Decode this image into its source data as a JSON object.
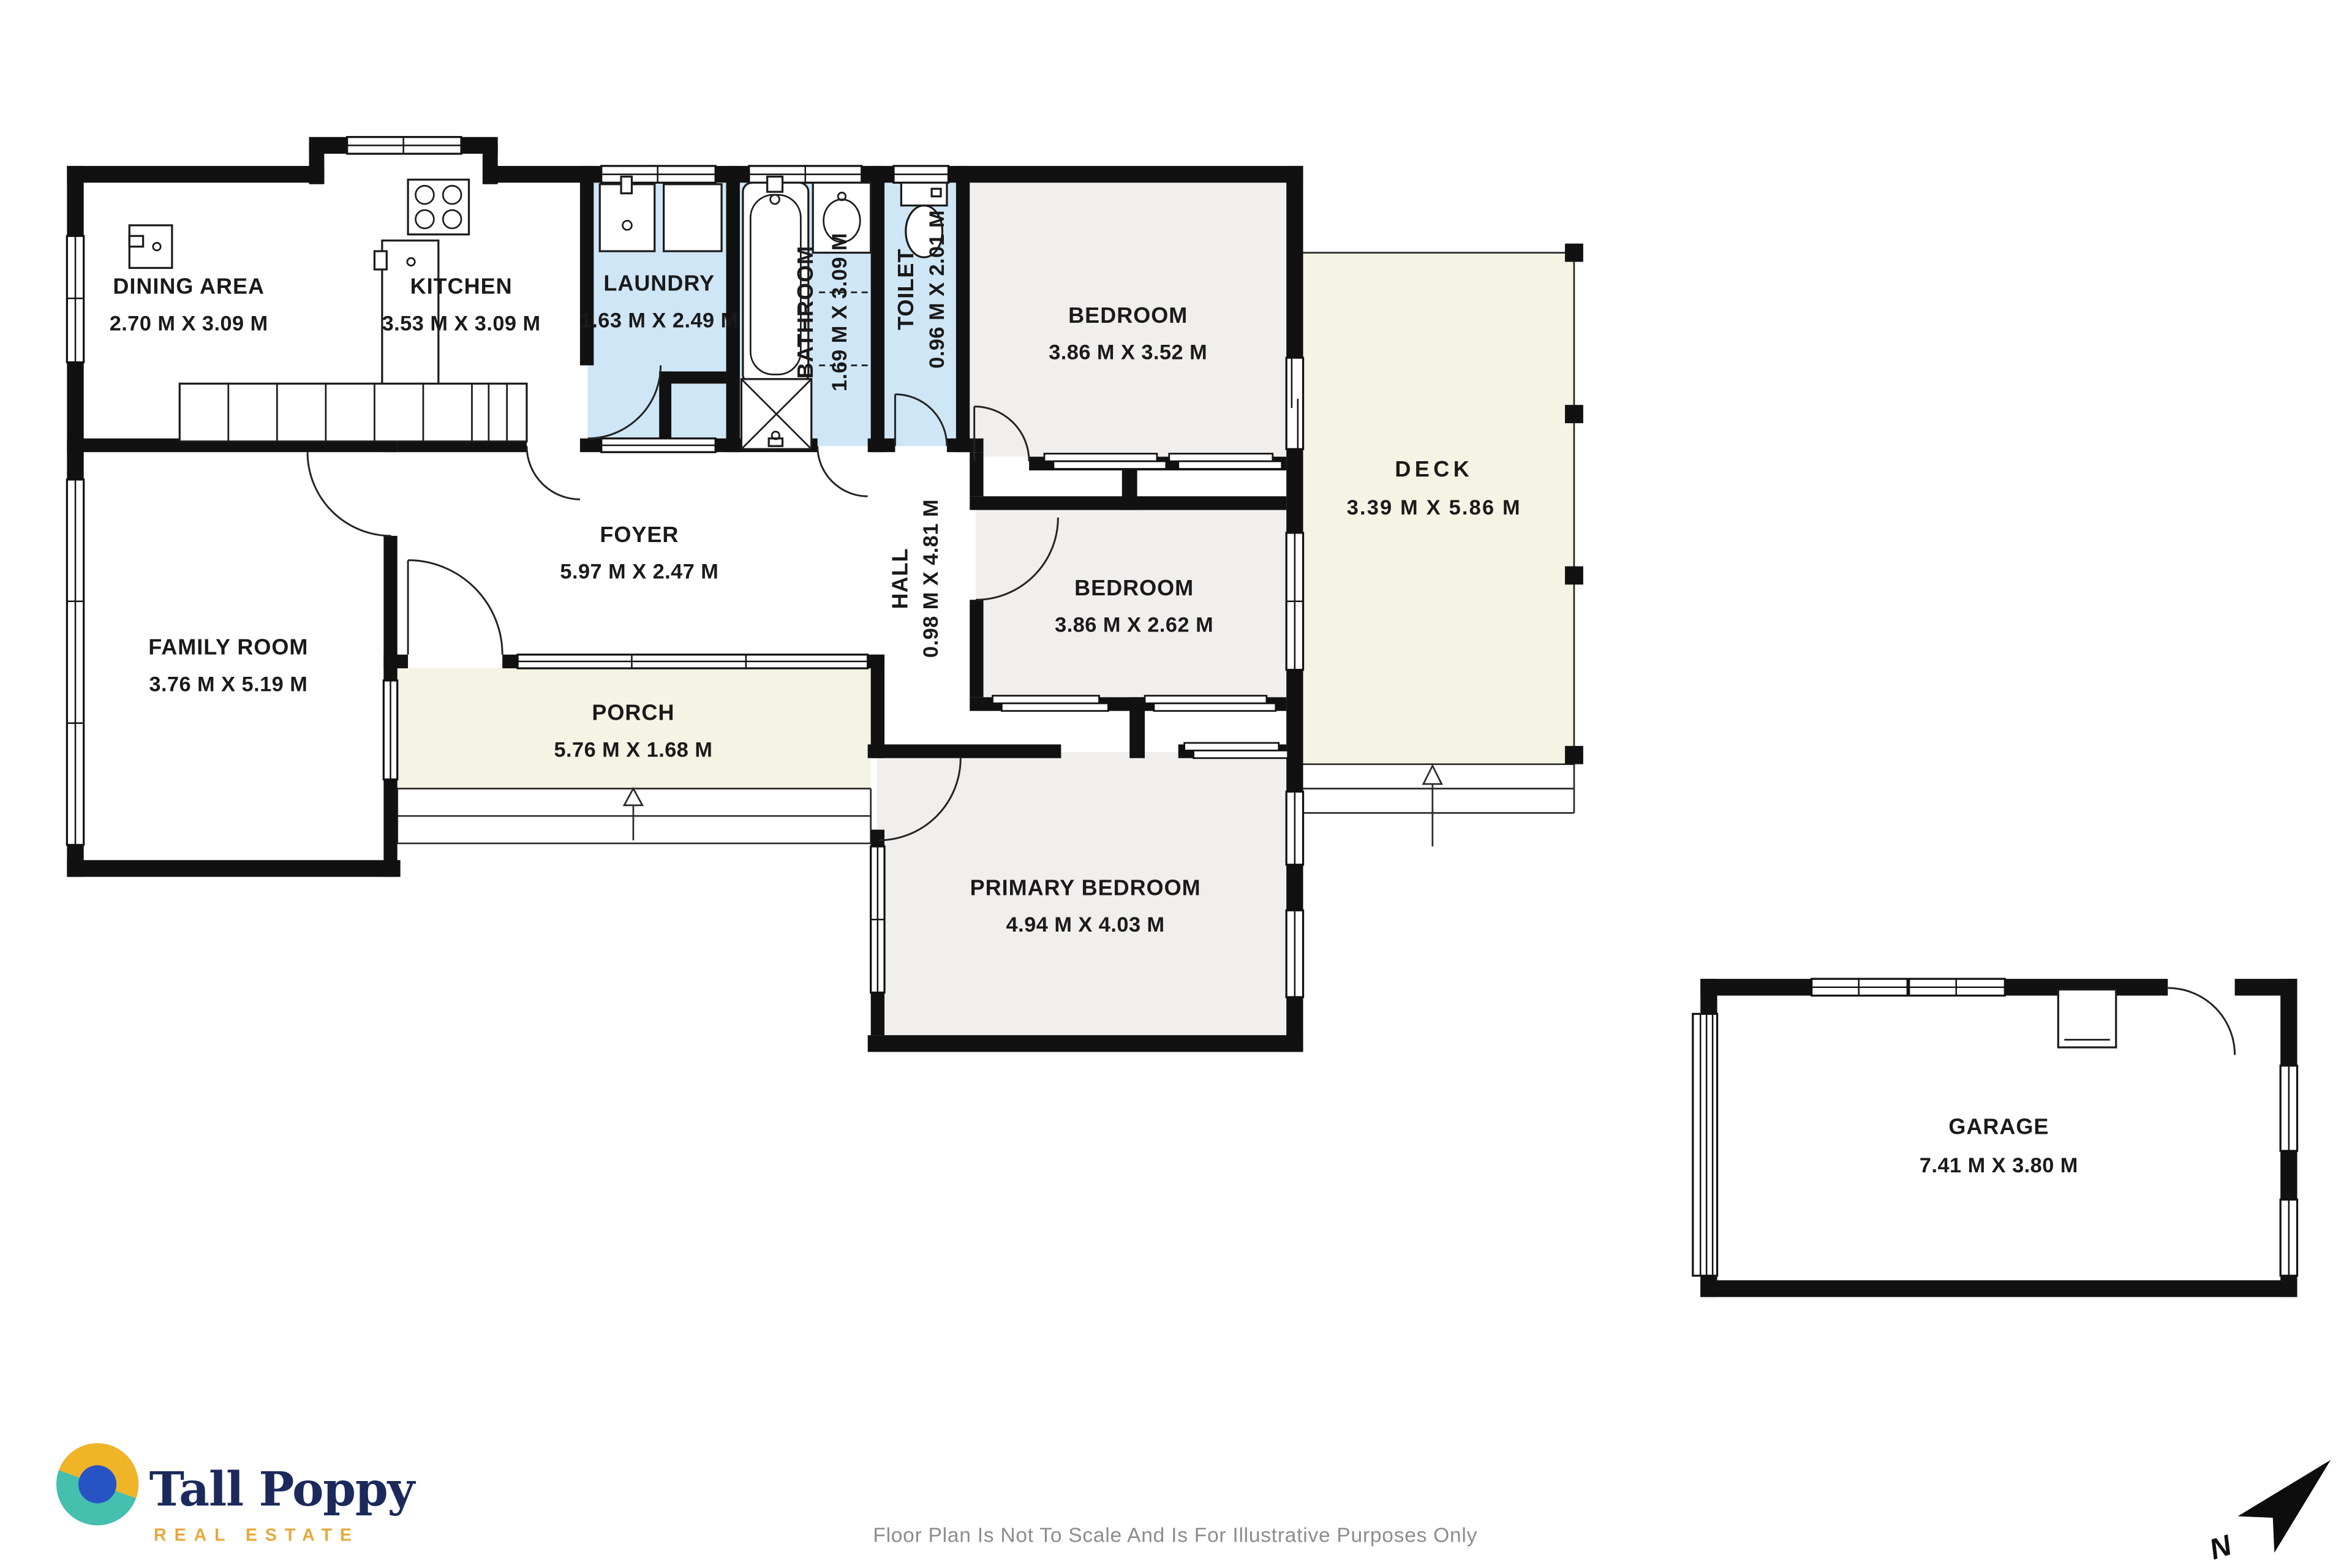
{
  "colors": {
    "wall": "#111111",
    "wet": "#cfe6f6",
    "bedroom": "#f0efed",
    "outdoor": "#f4f3e4",
    "label": "#1a1a1a",
    "footer_text": "#8c8c8c",
    "brand_navy": "#1b2a5b",
    "brand_gold": "#e7a83c",
    "brand_teal": "#45bfae",
    "brand_yellow": "#f0b429",
    "brand_blue": "#2853c4"
  },
  "rooms": {
    "dining": {
      "name": "DINING AREA",
      "dims": "2.70 M X 3.09 M"
    },
    "kitchen": {
      "name": "KITCHEN",
      "dims": "3.53 M X 3.09 M"
    },
    "laundry": {
      "name": "LAUNDRY",
      "dims": "1.63 M X 2.49 M"
    },
    "bathroom": {
      "name": "BATHROOM",
      "dims": "1.69 M X 3.09 M"
    },
    "toilet": {
      "name": "TOILET",
      "dims": "0.96 M X 2.01 M"
    },
    "bedroom1": {
      "name": "BEDROOM",
      "dims": "3.86 M X 3.52 M"
    },
    "deck": {
      "name": "DECK",
      "dims": "3.39 M X 5.86 M"
    },
    "family": {
      "name": "FAMILY ROOM",
      "dims": "3.76 M X 5.19 M"
    },
    "foyer": {
      "name": "FOYER",
      "dims": "5.97 M X 2.47 M"
    },
    "hall": {
      "name": "HALL",
      "dims": "0.98 M X 4.81 M"
    },
    "bedroom2": {
      "name": "BEDROOM",
      "dims": "3.86 M X 2.62 M"
    },
    "porch": {
      "name": "PORCH",
      "dims": "5.76 M X 1.68 M"
    },
    "primary": {
      "name": "PRIMARY BEDROOM",
      "dims": "4.94 M X 4.03 M"
    },
    "garage": {
      "name": "GARAGE",
      "dims": "7.41 M X 3.80 M"
    }
  },
  "brand": {
    "name": "Tall Poppy",
    "tagline": "REAL ESTATE"
  },
  "compass": {
    "label": "N"
  },
  "footer": {
    "disclaimer": "Floor Plan Is Not To Scale And Is For Illustrative Purposes Only"
  }
}
